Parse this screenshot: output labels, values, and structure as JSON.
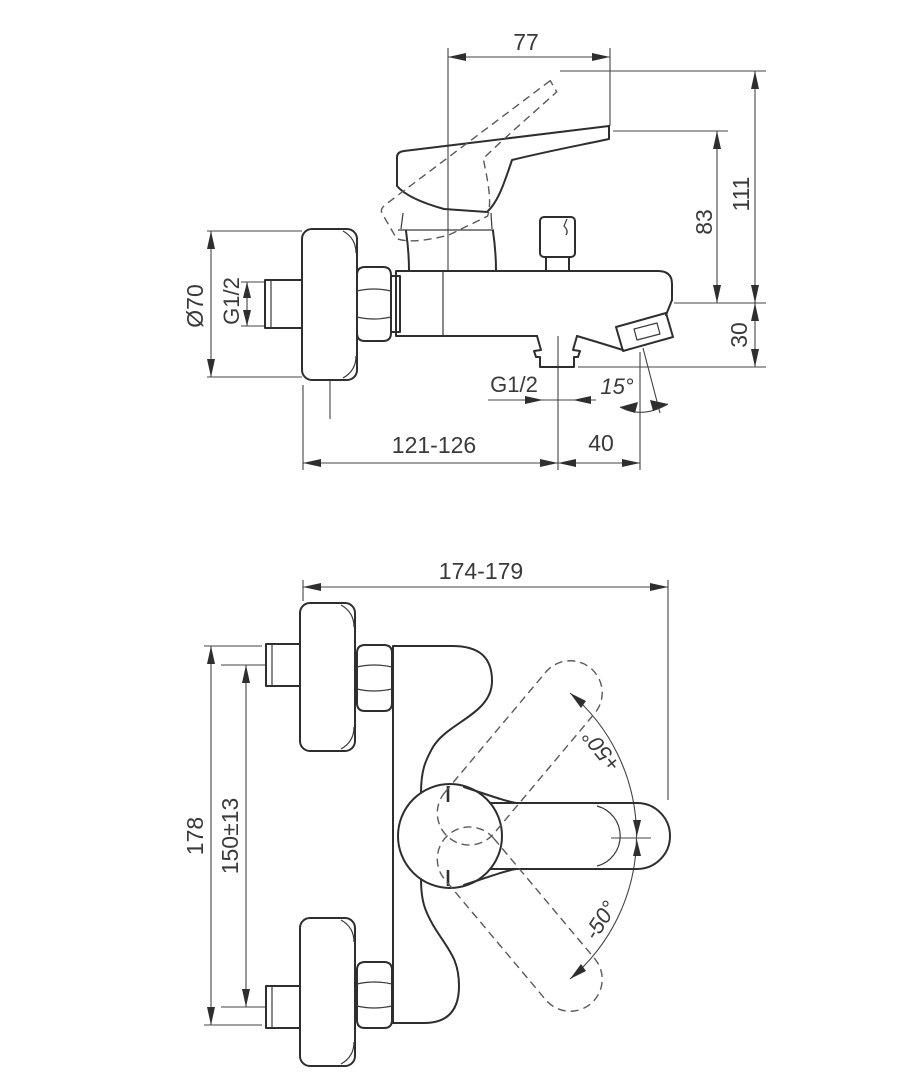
{
  "drawing": {
    "background": "#ffffff",
    "stroke_color": "#2e2e2e",
    "text_color": "#3a3a3a",
    "side_view": {
      "dim_handle_projection": "77",
      "dim_height_overall": "111",
      "dim_height_handle": "83",
      "dim_spout_drop": "30",
      "dim_escutcheon_diameter": "Ø70",
      "dim_inlet_thread": "G1/2",
      "dim_outlet_thread": "G1/2",
      "dim_spout_angle": "15°",
      "dim_wall_to_outlet": "121-126",
      "dim_outlet_to_spout_tip": "40"
    },
    "top_view": {
      "dim_depth_overall": "174-179",
      "dim_span_overall": "178",
      "dim_connection_centers": "150±13",
      "dim_handle_swing_up": "+50°",
      "dim_handle_swing_down": "-50°"
    }
  }
}
